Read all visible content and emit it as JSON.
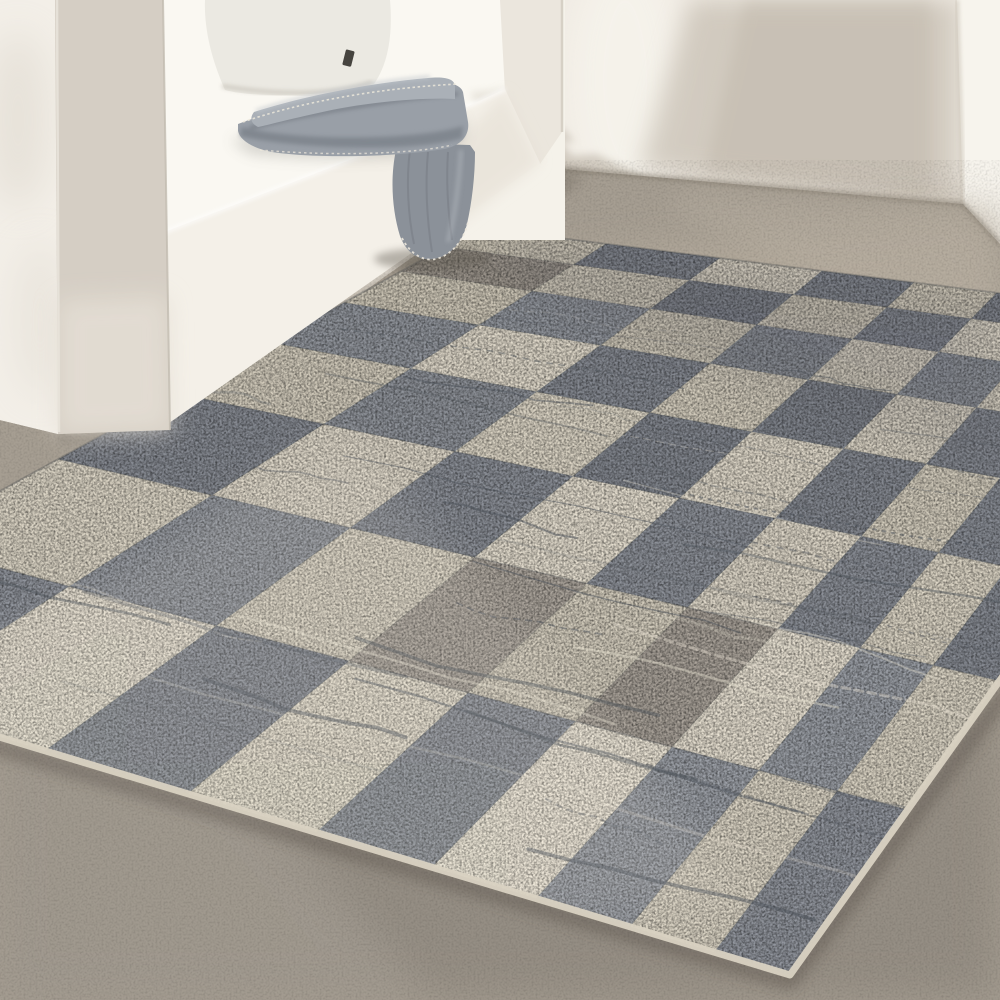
{
  "scene": {
    "kind": "interior-photo",
    "description": "Distressed gray and cream checkerboard area rug on a concrete floor beside a white built-in bench niche with white cushions, a white pillow and a folded heather-gray blanket with whipstitch edging draped over the bench edge",
    "objects": [
      "left-wall",
      "back-wall",
      "right-wall-panel",
      "bench-pillar",
      "bench-niche",
      "back-cushion",
      "pillow",
      "pillow-tag",
      "seat-cushion",
      "bench-base",
      "blanket-stack",
      "blanket-tail",
      "concrete-floor",
      "checkered-rug"
    ],
    "palette": {
      "wall": "#efeae2",
      "wallShadow": "#b9b0a3",
      "wallBright": "#f7f4ed",
      "wallStripe": "#f3efe8",
      "floor": "#a69e92",
      "floorLight": "#b7ad9f",
      "floorDark": "#8d867d",
      "junction": "#8a8278",
      "bench": "#f5f2ea",
      "benchFace": "#f4f0e8",
      "pillar": "#d5cec4",
      "pillarLight": "#e5dfd5",
      "jamb": "#ebe6dd",
      "cushion": "#faf8f2",
      "pillow": "#ebe9e2",
      "pillowShade": "#d8d4cb",
      "tag": "#46443f",
      "blanket": "#999fa7",
      "blanketTop": "#aab0b7",
      "blanketLight": "#c3c8cd",
      "blanketDark": "#6a7078",
      "tail": "#8b9199",
      "stitch": "#ece7db",
      "shadowSoft": "#5d584f",
      "binding": "#d9d2c2",
      "scratch": "#4c525a",
      "lightStreak": "#ece5d5"
    },
    "rug": {
      "corners": {
        "A": [
          480,
          228
        ],
        "B": [
          1253,
          325
        ],
        "C": [
          790,
          975
        ],
        "D": [
          -290,
          650
        ]
      },
      "cols": 9,
      "rows": 8,
      "col_ratio": 0.9,
      "row_ratio": 1.28,
      "seed": 7,
      "streak_count": 58,
      "colors": {
        "creams": [
          "#ddd6c6",
          "#e3dccd",
          "#d7d0c0"
        ],
        "grays": [
          "#979ba2",
          "#8b8f97"
        ],
        "gray_warm": "#a8a198",
        "seam": "#5a6068"
      }
    }
  }
}
